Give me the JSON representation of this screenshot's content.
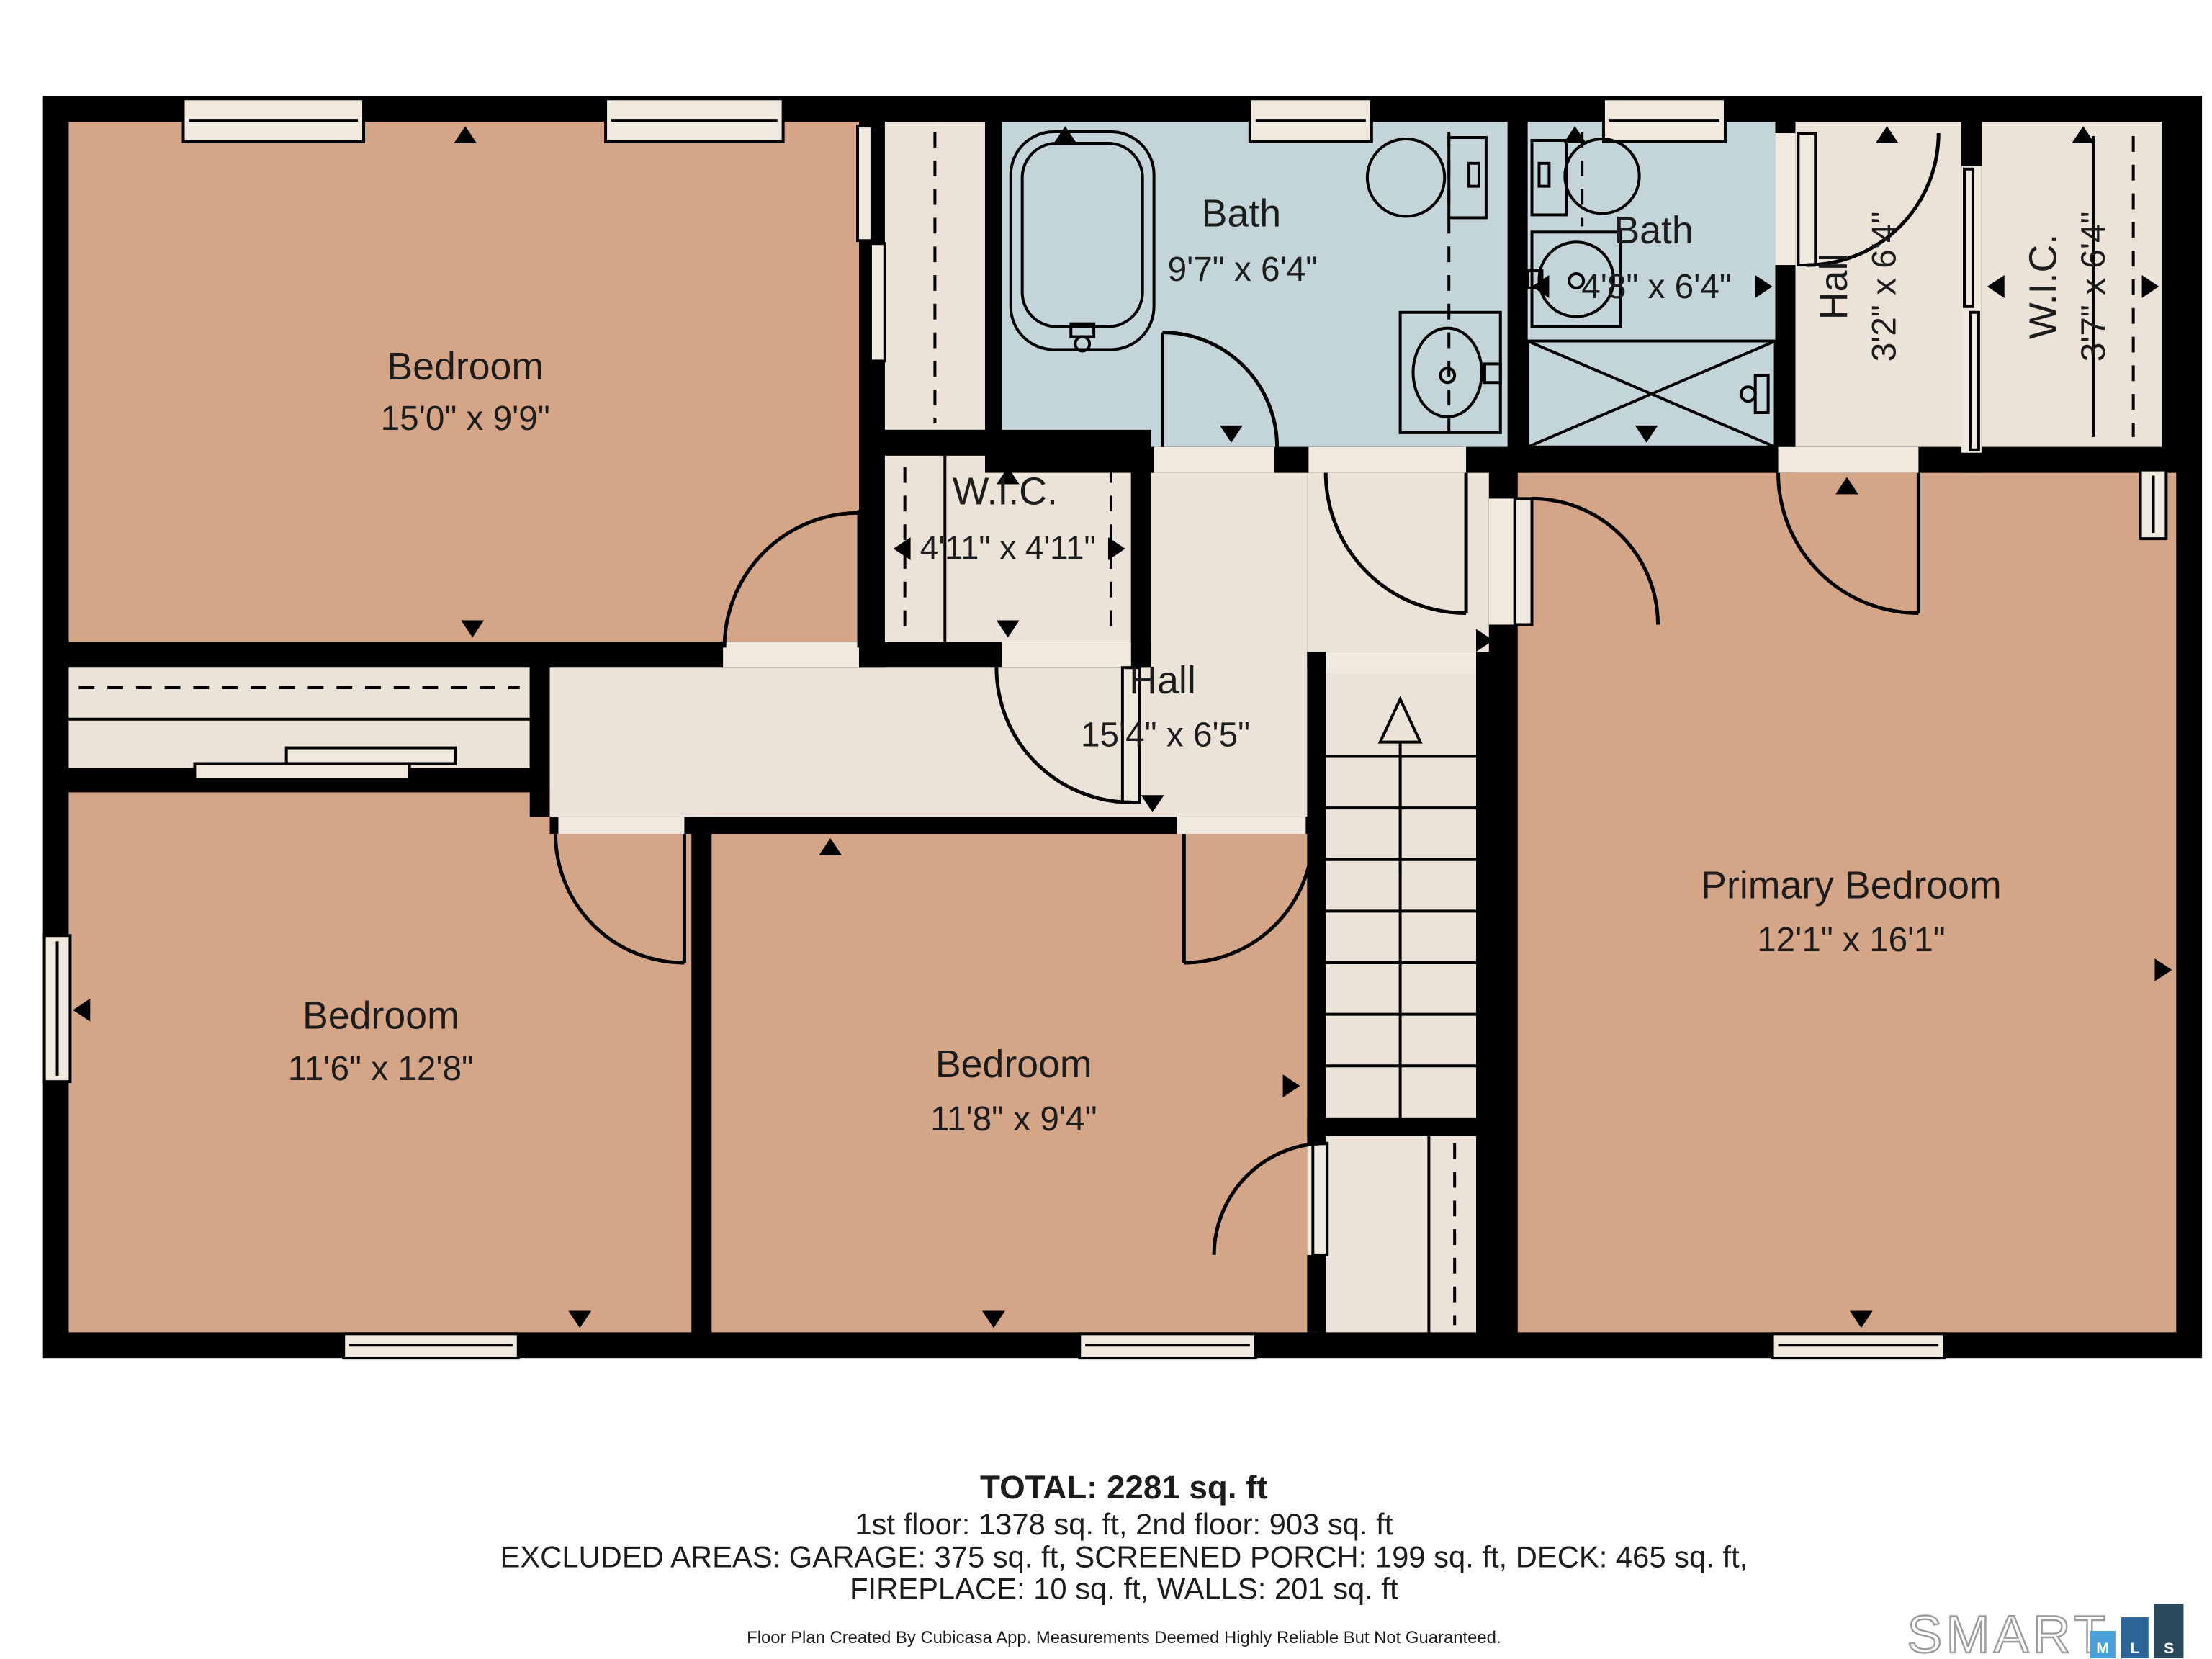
{
  "plan": {
    "rooms": [
      {
        "id": "bedroom-top-left",
        "name": "Bedroom",
        "dims": "15'0\" x 9'9\""
      },
      {
        "id": "bath-main",
        "name": "Bath",
        "dims": "9'7\" x 6'4\""
      },
      {
        "id": "bath-small",
        "name": "Bath",
        "dims": "4'8\" x 6'4\""
      },
      {
        "id": "hall-upper",
        "name": "Hall",
        "dims": "3'2\" x 6'4\""
      },
      {
        "id": "wic-upper",
        "name": "W.I.C.",
        "dims": "3'7\" x 6'4\""
      },
      {
        "id": "wic-small",
        "name": "W.I.C.",
        "dims": "4'11\" x 4'11\""
      },
      {
        "id": "hall-main",
        "name": "Hall",
        "dims": "15'4\" x 6'5\""
      },
      {
        "id": "bedroom-bottom-left",
        "name": "Bedroom",
        "dims": "11'6\" x 12'8\""
      },
      {
        "id": "bedroom-bottom-middle",
        "name": "Bedroom",
        "dims": "11'8\" x 9'4\""
      },
      {
        "id": "primary-bedroom",
        "name": "Primary Bedroom",
        "dims": "12'1\" x 16'1\""
      }
    ]
  },
  "summary": {
    "total": "TOTAL: 2281 sq. ft",
    "floors": "1st floor: 1378 sq. ft, 2nd floor: 903 sq. ft",
    "excluded1": "EXCLUDED AREAS: GARAGE: 375 sq. ft, SCREENED PORCH: 199 sq. ft, DECK: 465 sq. ft,",
    "excluded2": "FIREPLACE: 10 sq. ft, WALLS: 201 sq. ft",
    "disclaimer": "Floor Plan Created By Cubicasa App. Measurements Deemed Highly Reliable But Not Guaranteed."
  },
  "logo": {
    "wordmark": "SMART",
    "bars": [
      {
        "letter": "M",
        "color": "#4aa0d9"
      },
      {
        "letter": "L",
        "color": "#2c6598"
      },
      {
        "letter": "S",
        "color": "#294a5c"
      }
    ]
  },
  "colors": {
    "floor_tan": "#d4a687",
    "floor_cream": "#ece3d8",
    "bath_blue": "#c3d5d8",
    "wall_black": "#000000",
    "background": "#ffffff"
  }
}
